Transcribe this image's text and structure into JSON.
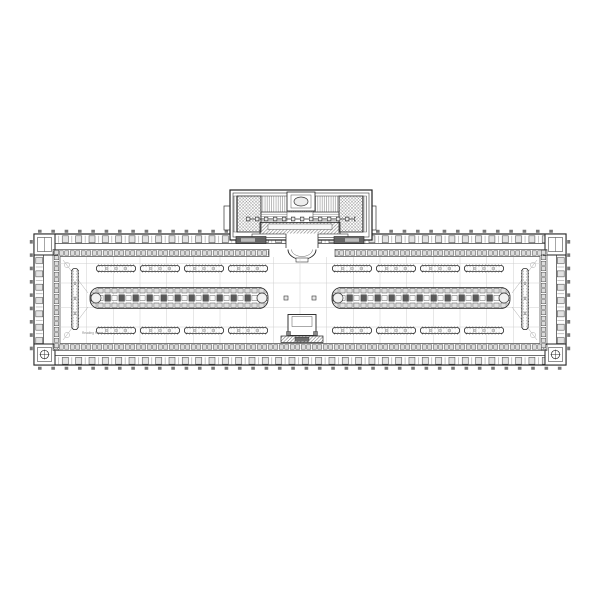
{
  "document": {
    "type": "architectural-floor-plan",
    "room_label": "Reading Room"
  },
  "colors": {
    "paper": "#ffffff",
    "ink": "#2a2a2a",
    "wall_cell_fill": "#e3e3e3",
    "stack_fill": "#dcdcdc",
    "dark_block": "#5a5a5a",
    "grid_line": "#cfcfcf"
  }
}
